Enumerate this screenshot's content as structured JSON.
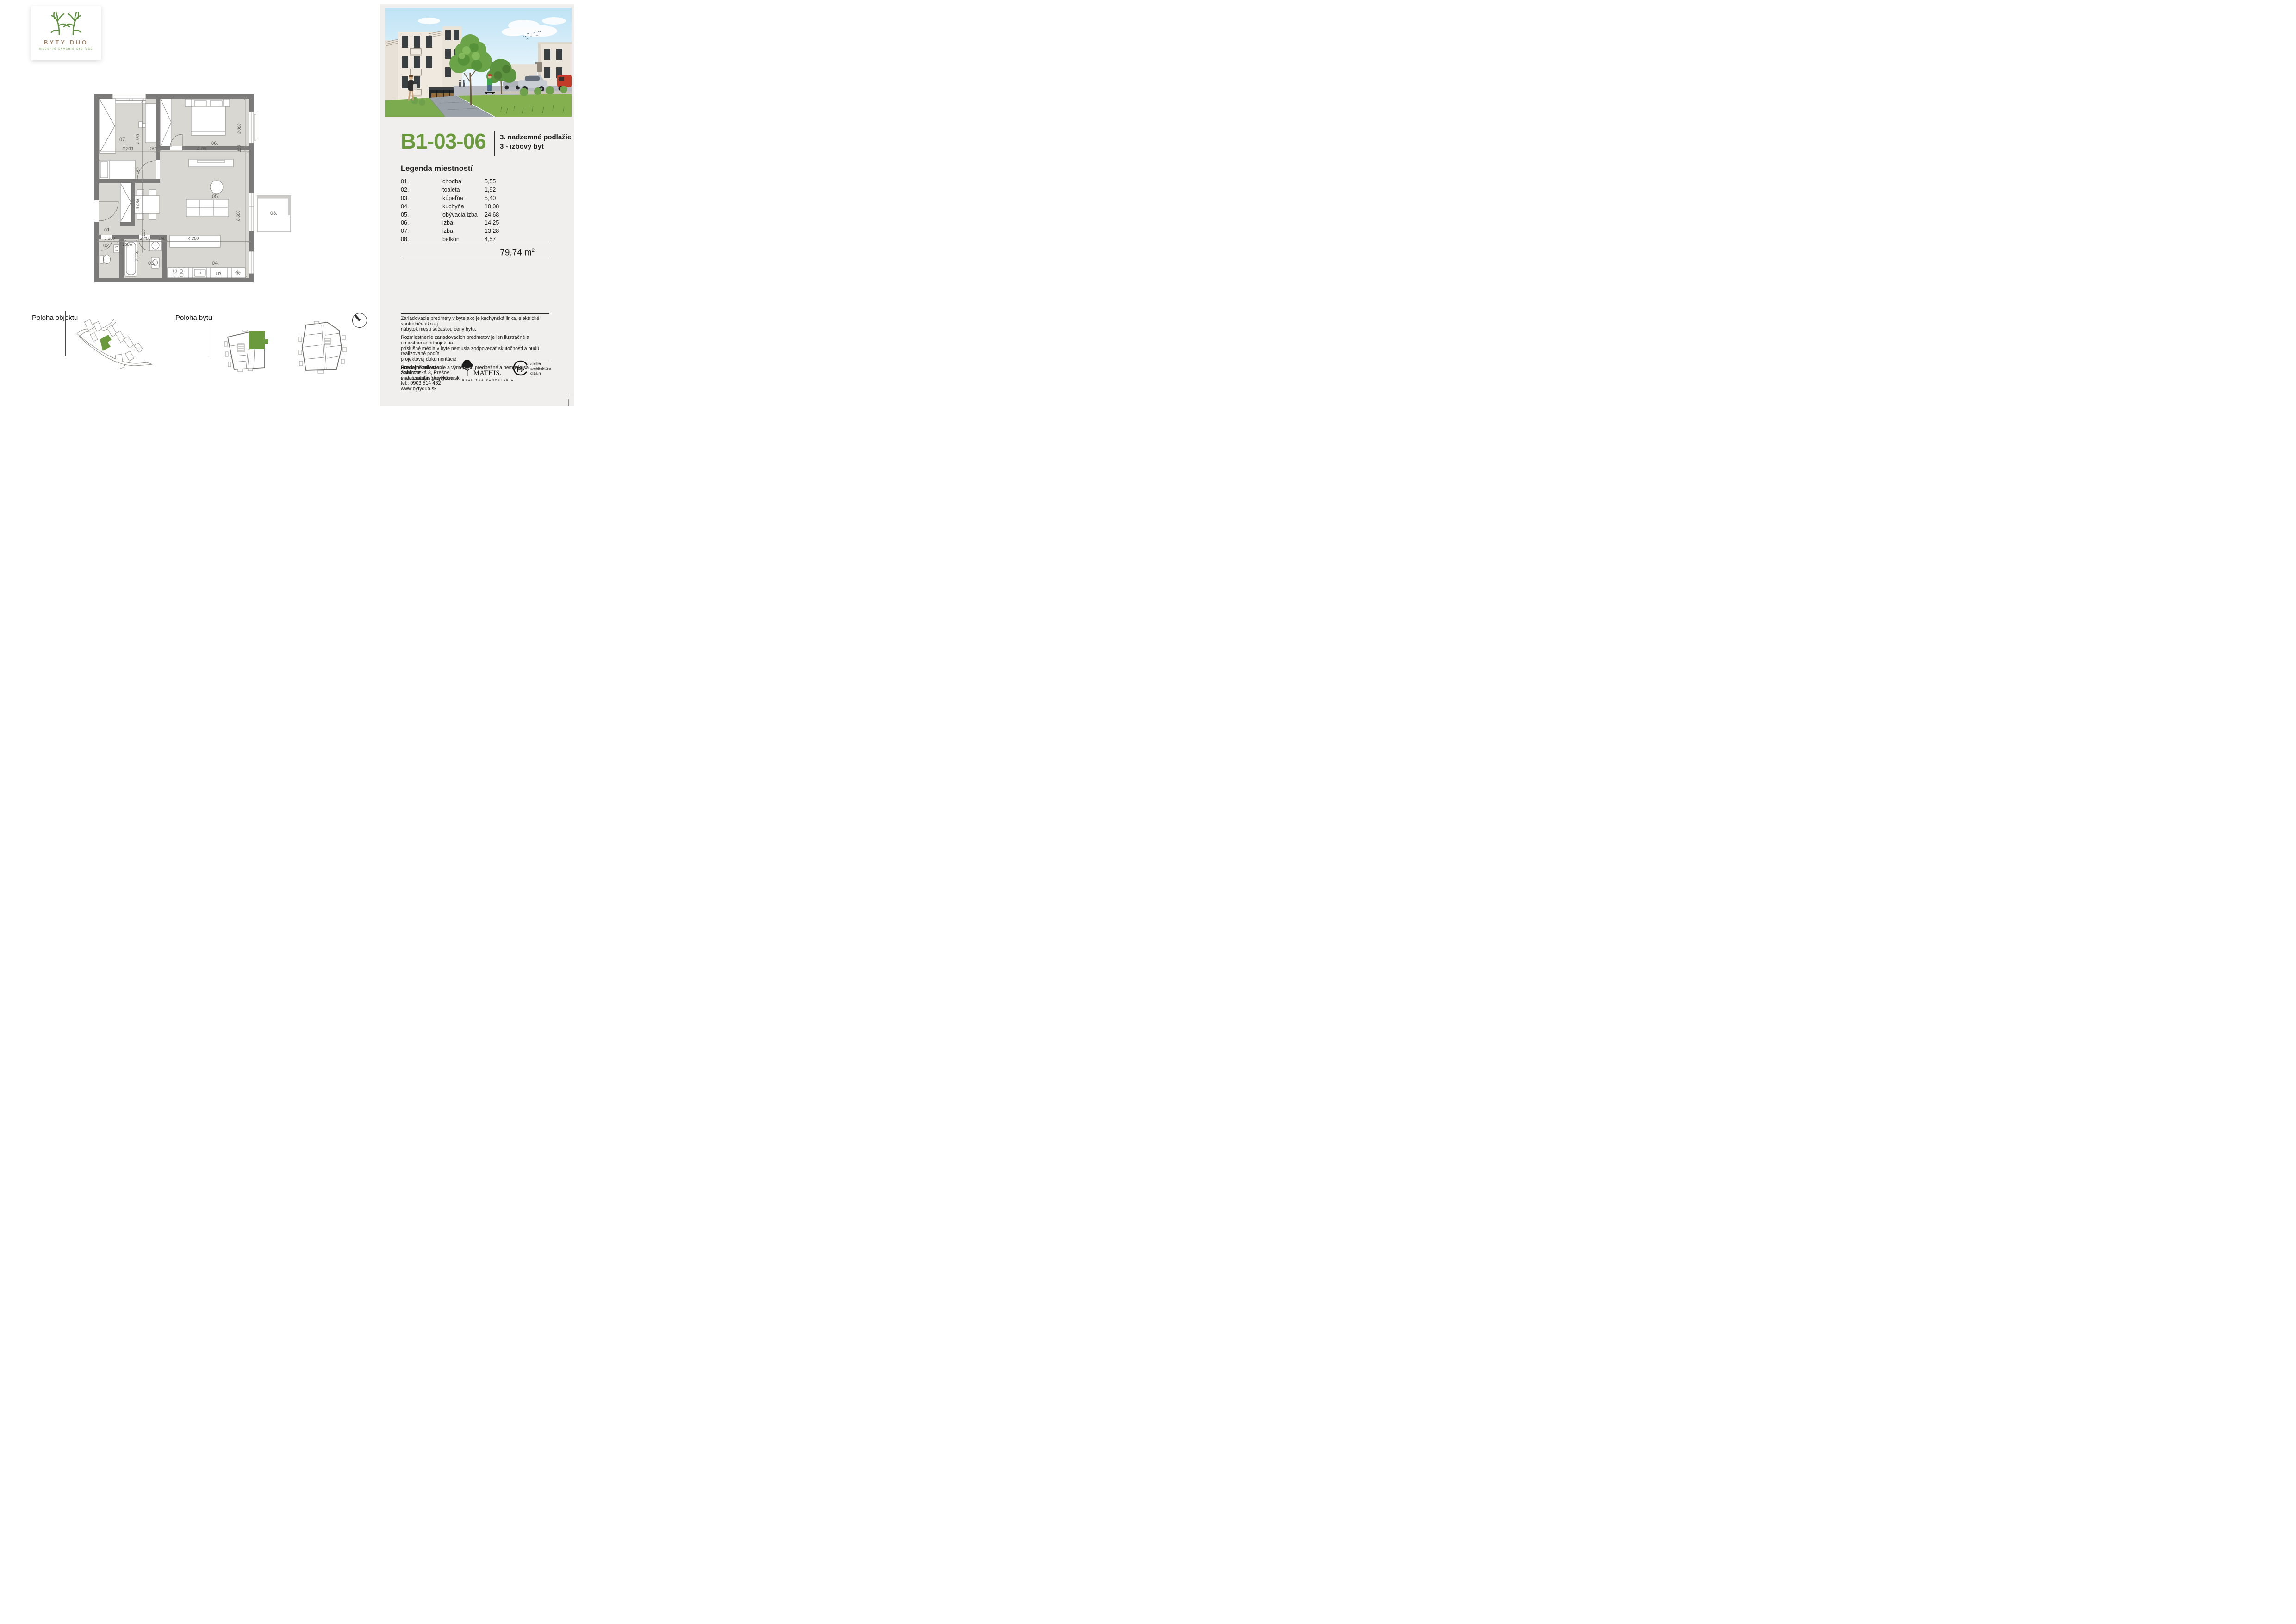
{
  "brand": {
    "name": "BYTY DUO",
    "tagline": "moderné bývanie pre Vás"
  },
  "unit": {
    "id": "B1-03-06",
    "floor": "3. nadzemné podlažie",
    "type": "3 - izbový byt"
  },
  "legend": {
    "title": "Legenda miestností",
    "rows": [
      {
        "num": "01.",
        "name": "chodba",
        "area": "5,55"
      },
      {
        "num": "02.",
        "name": "toaleta",
        "area": "1,92"
      },
      {
        "num": "03.",
        "name": "kúpeľňa",
        "area": "5,40"
      },
      {
        "num": "04.",
        "name": "kuchyňa",
        "area": "10,08"
      },
      {
        "num": "05.",
        "name": "obývacia izba",
        "area": "24,68"
      },
      {
        "num": "06.",
        "name": "izba",
        "area": "14,25"
      },
      {
        "num": "07.",
        "name": "izba",
        "area": "13,28"
      },
      {
        "num": "08.",
        "name": "balkón",
        "area": "4,57"
      }
    ],
    "total_value": "79,74",
    "total_unit": "m",
    "total_exp": "2"
  },
  "plan": {
    "rooms": {
      "r01": "01.",
      "r02": "02.",
      "r03": "03.",
      "r04": "04.",
      "r05": "05.",
      "r06": "06.",
      "r07": "07.",
      "r08": "08."
    },
    "appliance_label": "UR",
    "dims": {
      "w07": "3 200",
      "w07_wall": "150",
      "w06": "4 750",
      "h07": "4 150",
      "h07_wall": "150",
      "h06": "3 000",
      "h06_wall": "150",
      "h_total": "6 600",
      "b1200": "1 200",
      "b2400": "2 400",
      "b150": "150",
      "b4200": "4 200",
      "b150b": "150",
      "v150": "150",
      "v2250": "2 250",
      "v3050": "3 050"
    }
  },
  "location": {
    "object_label": "Poloha objektu",
    "flat_label": "Poloha bytu"
  },
  "disclaimers": {
    "p1": "Zariaďovacie predmety v byte ako je kuchynská linka, elektrické spotrebiče ako aj\nnábytok niesu súčasťou ceny bytu.",
    "p2": "Rozmiestnenie zariaďovacích predmetov je len ilustračné a umiestnenie prípojok na\npríslušné média v byte nemusia zodpovedať skutočnosti a budú realizované podľa\nprojektovej dokumentácie.",
    "p3": "Uvedené zobrazenie a výmery sú predbežné a nemusia sa zhodovať\n s realizačným projektom."
  },
  "contact": {
    "heading": "Predajné miesto:",
    "address": "Sabinovská 3, Prešov",
    "email": "matus.mathis@bytyduo.sk",
    "phone": "tel.: 0903 514 462",
    "web": "www.bytyduo.sk"
  },
  "partners": {
    "mathis": {
      "name": "MATHIS.",
      "subtitle": "REALITNÁ KANCELÁRIA"
    },
    "pj": {
      "monogram": "pj.",
      "line1": "ateliér",
      "line2": "architektúra",
      "line3": "dizajn"
    }
  },
  "colors": {
    "accent_green": "#6b9a3e",
    "logo_brown": "#9c8065",
    "panel_bg": "#f0efee",
    "wall": "#7c7b79",
    "floor": "#d9d7d1"
  }
}
